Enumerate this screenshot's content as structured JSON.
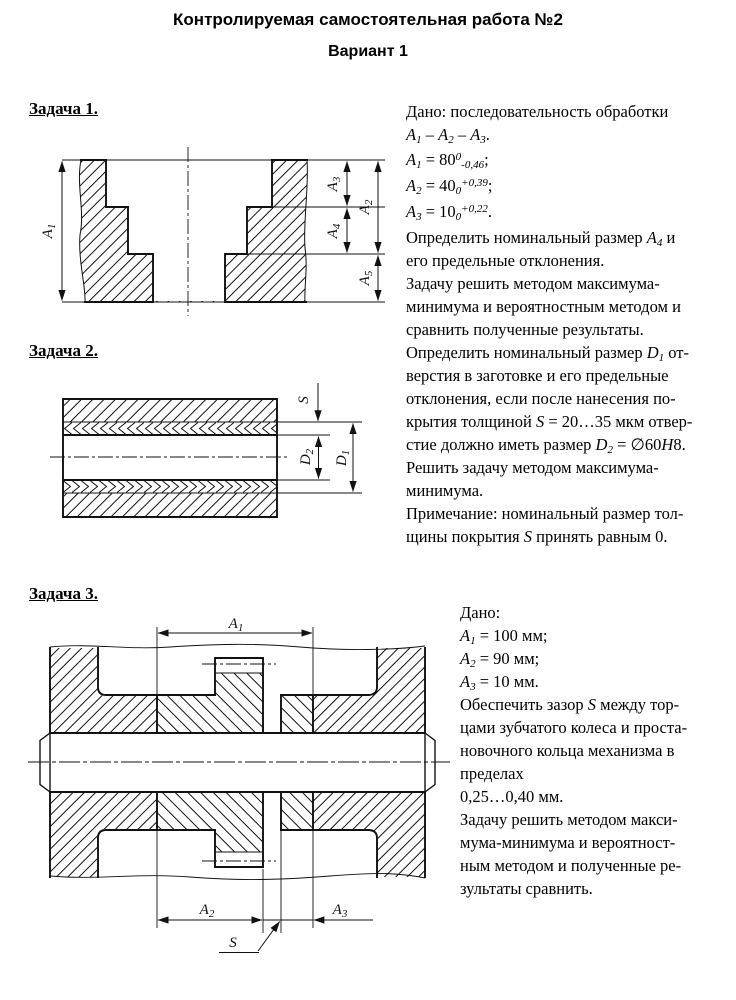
{
  "page": {
    "title": "Контролируемая самостоятельная работа №2",
    "subtitle": "Вариант 1"
  },
  "tasks": [
    {
      "header": "Задача 1.",
      "lines": [
        "Дано: последовательность обработки",
        "*А*_1_ – *А*_2_ – *А*_3_.",
        "*А*_1_ = 80^0^_-0,46_;",
        "*А*_2_ = 40_0_^+0,39^;",
        "*А*_3_ = 10_0_^+0,22^.",
        "Определить номинальный размер *А*_4_ и",
        "его предельные отклонения.",
        "Задачу решить методом максимума-",
        "минимума и вероятностным методом и",
        "сравнить полученные результаты."
      ],
      "labels": {
        "a1": [
          "А",
          "1"
        ],
        "a2": [
          "А",
          "2"
        ],
        "a3": [
          "А",
          "3"
        ],
        "a4": [
          "А",
          "4"
        ],
        "a5": [
          "А",
          "5"
        ]
      }
    },
    {
      "header": "Задача 2.",
      "lines": [
        "Определить номинальный размер *D*_1_  от-",
        "верстия в заготовке и его предельные",
        "отклонения, если после нанесения по-",
        "крытия толщиной *S* = 20…35 мкм отвер-",
        "стие должно  иметь размер *D*_2_ = ∅60*H*8.",
        "Решить задачу методом максимума-",
        "минимума.",
        "Примечание: номинальный размер тол-",
        "щины покрытия *S* принять равным 0."
      ],
      "labels": {
        "s": [
          "S",
          ""
        ],
        "d1": [
          "D",
          "1"
        ],
        "d2": [
          "D",
          "2"
        ]
      }
    },
    {
      "header": "Задача 3.",
      "lines": [
        "Дано:",
        "*А*_1_ = 100 мм;",
        "*А*_2_ = 90 мм;",
        "*А*_3_ = 10 мм.",
        "Обеспечить зазор *S* между тор-",
        "цами зубчатого колеса и проста-",
        "новочного кольца механизма в",
        "пределах",
        "0,25…0,40 мм.",
        "Задачу решить методом макси-",
        "мума-минимума и вероятност-",
        "ным методом и полученные ре-",
        "зультаты сравнить."
      ],
      "labels": {
        "a1": [
          "А",
          "1"
        ],
        "a2": [
          "А",
          "2"
        ],
        "a3": [
          "А",
          "3"
        ],
        "s": [
          "S",
          ""
        ]
      }
    }
  ]
}
